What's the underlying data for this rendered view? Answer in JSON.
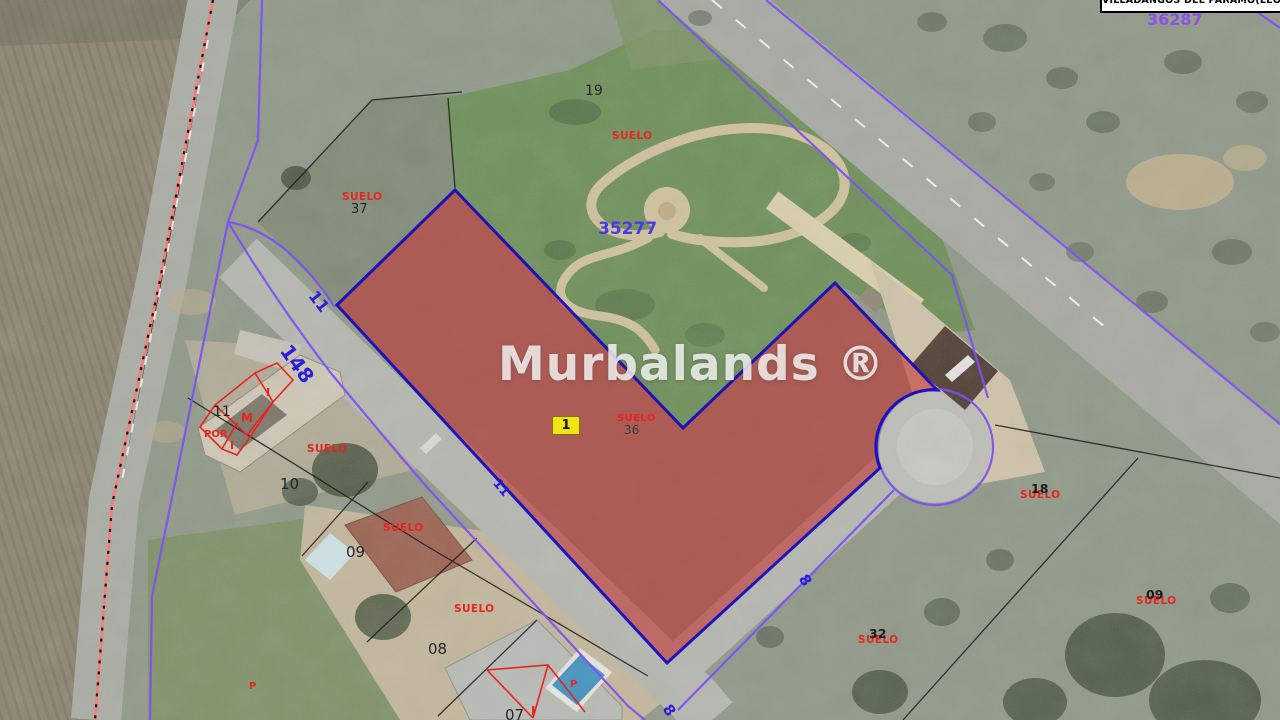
{
  "header": {
    "municipality": "VILLADANGOS DEL PARAMO(LEON)",
    "sector_code": "36287"
  },
  "watermark": "Murbalands ®",
  "parcel_overlay": {
    "badge": "1",
    "reference": "35277"
  },
  "labels": {
    "suelo": "SUELO"
  },
  "parcel_numbers": {
    "n19": "19",
    "n37": "37",
    "n36": "36",
    "n11": "11",
    "n10": "10",
    "n09": "09",
    "n08": "08",
    "n07": "07",
    "n18": "18",
    "n32": "32"
  },
  "street_numbers": {
    "s11": "11",
    "s148": "148",
    "s8": "8"
  },
  "building_marks": {
    "i": "I",
    "m": "M",
    "por": "POR",
    "p": "P"
  },
  "colors": {
    "parcel_fill": "#c32222",
    "parcel_border": "#1508c0",
    "cadastral_purple": "#7e52f2",
    "suelo_red": "#e8241f",
    "street_blue": "#2b1fd8",
    "reference_blue": "#4b39e6",
    "sector_purple": "#8a52e8",
    "badge_yellow": "#f2e313"
  }
}
